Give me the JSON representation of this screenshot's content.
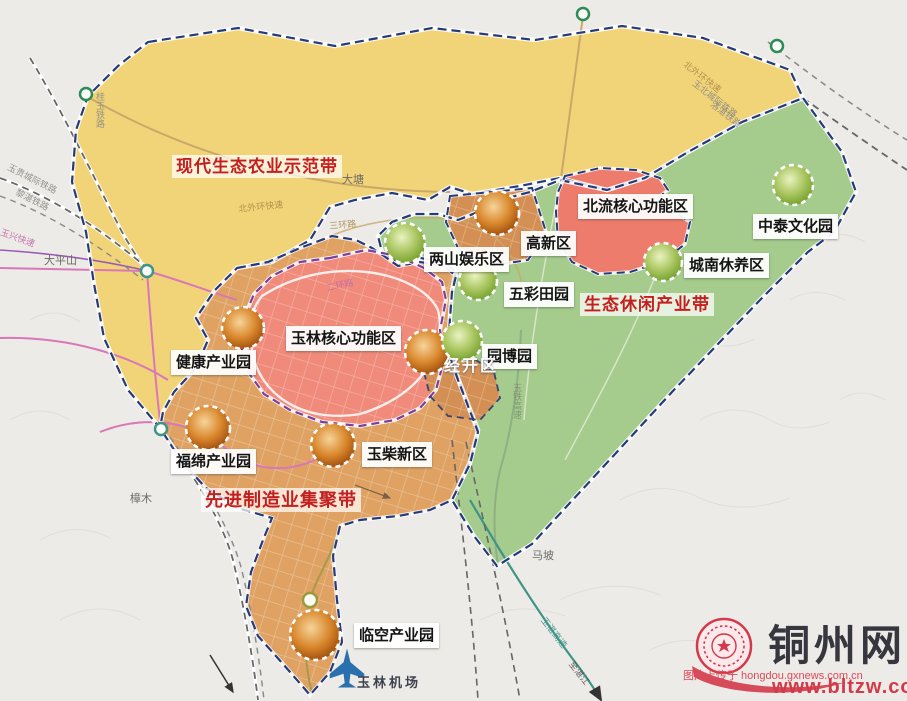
{
  "belts": {
    "agriculture": "现代生态农业示范带",
    "leisure": "生态休闲产业带",
    "manufacturing": "先进制造业集聚带"
  },
  "areas": {
    "beiliu_core": "北流核心功能区",
    "zhongtai": "中泰文化园",
    "gaoxin": "高新区",
    "liangshan": "两山娱乐区",
    "wucai": "五彩田园",
    "chengnan": "城南休养区",
    "yulin_core": "玉林核心功能区",
    "jiankang": "健康产业园",
    "yuanbo": "园博园",
    "jingkai": "经开区",
    "fumian": "福绵产业园",
    "yuchai": "玉柴新区",
    "linkong": "临空产业园"
  },
  "airport": {
    "label": "玉林机场"
  },
  "roads": {
    "guiyu_railway": "桂玉铁路",
    "yugui_intercity": "玉贵城际铁路",
    "lizhan_railway": "黎湛铁路",
    "yuxing_expwy": "玉兴快速",
    "north_outer_ring_w": "北外环快速",
    "third_ring": "三环路",
    "second_ring": "二环路",
    "north_outer_ring_e": "北外环快速",
    "yubei_intercity": "玉北城际铁路",
    "luozhan_railway": "洛湛铁路",
    "yutie_expwy": "玉铁高速",
    "yuzhan_expwy": "玉湛高速",
    "to_zhanjiang": "至湛江"
  },
  "places": {
    "datang": "大塘",
    "dapingshan": "大平山",
    "zhangmu": "樟木",
    "mapo": "马坡"
  },
  "watermark": {
    "site_name": "铜州网",
    "site_url": "www.bltzw.com",
    "credit": "图片上传于 hongdou.gxnews.com.cn"
  },
  "colors": {
    "background": "#edebe7",
    "agri_belt": "#f2d478",
    "eco_belt": "#a5cb8d",
    "manufacture_belt": "#dfa263",
    "core_pink": "#f08a7a",
    "beiliu_red": "#ee7c6c",
    "gaoxin_patch": "#d49054",
    "belt_label_red": "#c41f1f",
    "watermark_red": "#d23a4a",
    "airport_blue": "#2a6fae",
    "border_navy": "#233a7c",
    "core_border_purple": "#7a3f9d"
  }
}
